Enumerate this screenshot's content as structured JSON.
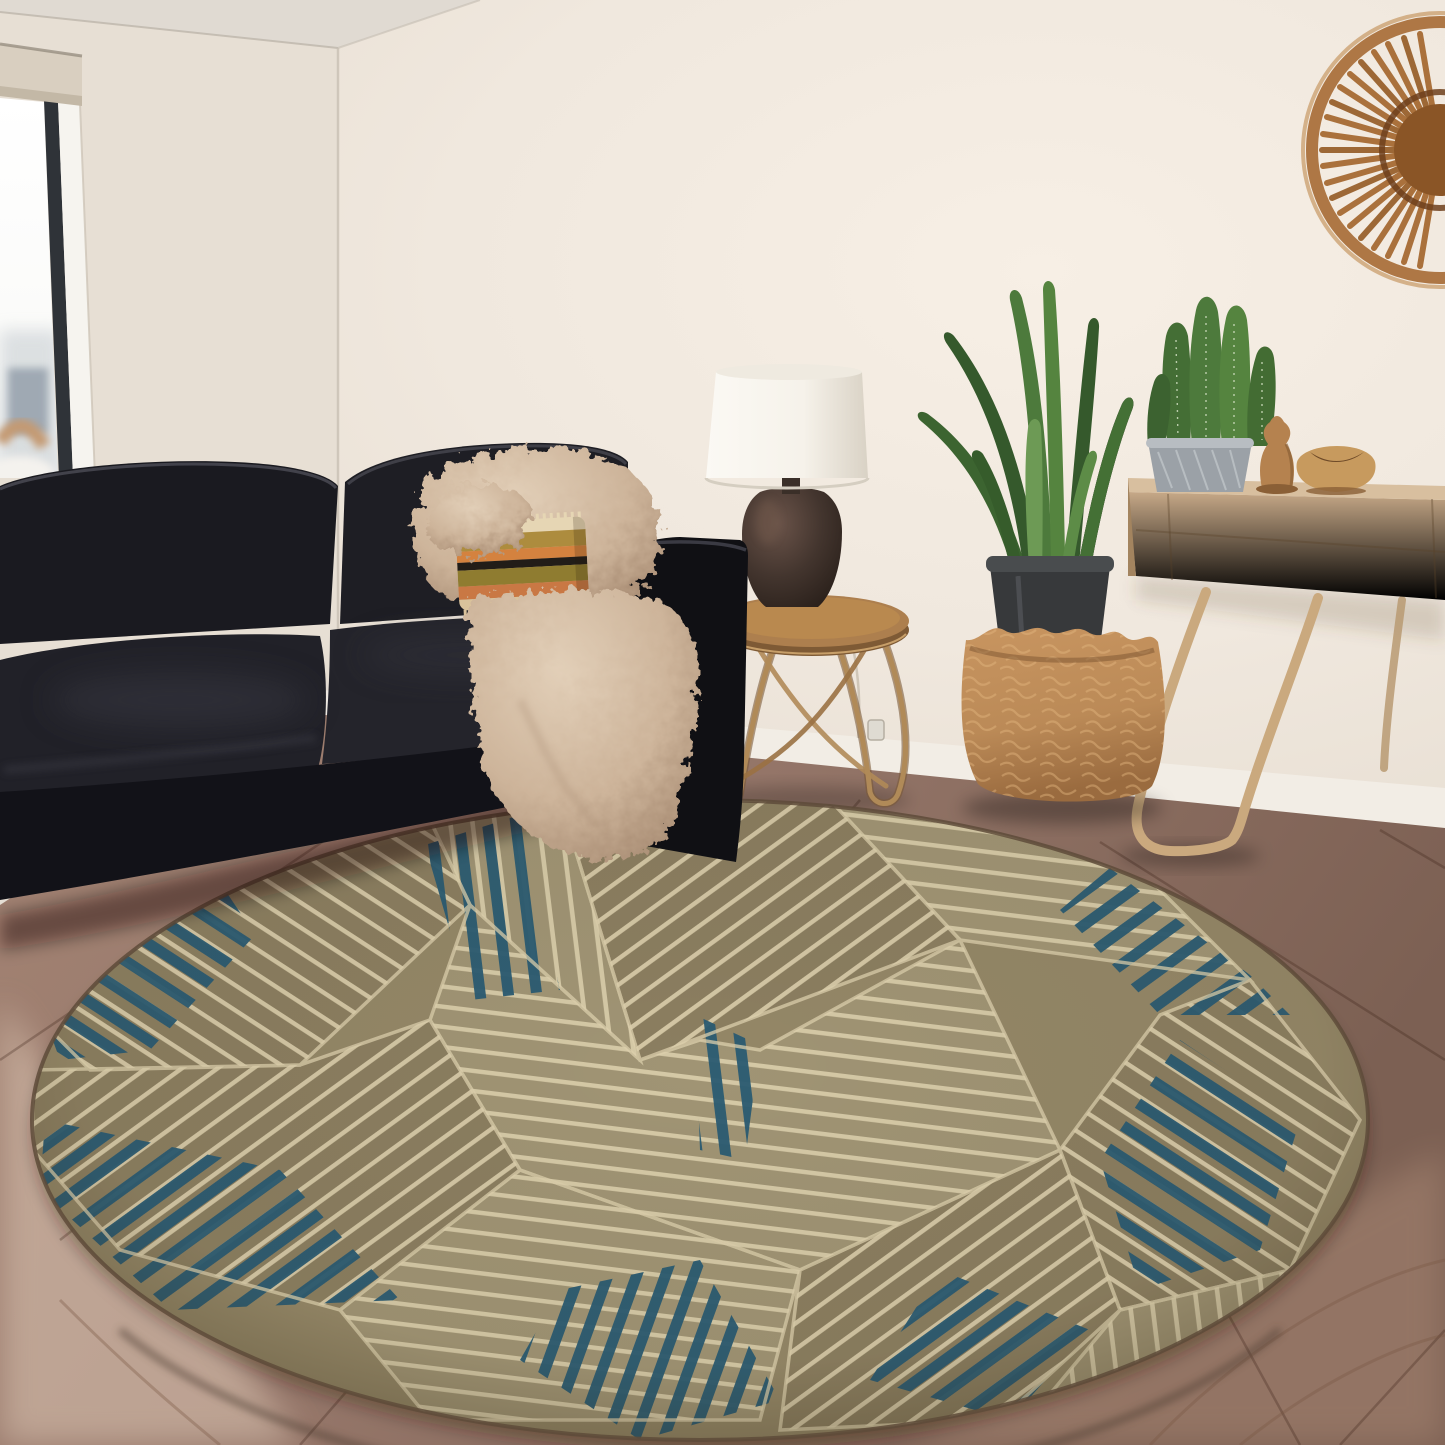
{
  "scene": {
    "alt": "Bright living room photo: black leather sofa with fur throw and striped boho pillow by a tall window, round side table with ceramic lamp, snake plant in a woven basket planter, oak console with cactus, wooden sculpture and bowl, rattan fan wall decor, and a round geometric area rug in taupe, cream and teal on warm hardwood flooring."
  },
  "objects": [
    "window-with-roller-shade",
    "black-leather-sofa",
    "fur-throw",
    "striped-boho-pillow",
    "round-side-table",
    "ceramic-table-lamp",
    "snake-plant",
    "woven-basket-planter",
    "oak-console-table",
    "potted-cactus",
    "wooden-sculpture",
    "wooden-bowl",
    "rattan-wall-fan",
    "round-geometric-area-rug",
    "hardwood-floor"
  ],
  "colors": {
    "wall": "#eee6dc",
    "wallLeft": "#e7dfd4",
    "ceiling": "#e0dad2",
    "floor": "#96776a",
    "floorDark": "#7c6053",
    "floorLight": "#dcc6b4",
    "baseboard": "#f2ede5",
    "windowFrame": "#2f3338",
    "glass": "#fafaf8",
    "shadeBeige": "#d9cfc0",
    "sofaBlack": "#1a1a20",
    "sofaDeep": "#101014",
    "sofaSeat": "#212128",
    "fur": "#cdb49a",
    "furLight": "#e2cfb8",
    "pillowCream": "#e6d6b4",
    "pillowGold": "#ad8c3e",
    "pillowOrange": "#d4823f",
    "pillowBlack": "#221d18",
    "pillowOlive": "#8f7c30",
    "pillowRust": "#c97844",
    "tableWood": "#ad7f4e",
    "wire": "#b08a58",
    "lampShade": "#f6f2ea",
    "lampBase": "#43352e",
    "plantGreen": "#4d7a3c",
    "plantDark": "#35592c",
    "plantLight": "#6d9a55",
    "potBlack": "#37393b",
    "basket": "#bb8a57",
    "basketLine": "#e3b77f",
    "console": "#c7a988",
    "consoleTop": "#d8bf9f",
    "legWood": "#caa97e",
    "potGray": "#9ba1a7",
    "sculpture": "#b5824f",
    "bowl": "#c79a5e",
    "rattan": "#aa713c",
    "rattanDark": "#8a5526",
    "rugBase": "#948767",
    "rugTone2": "#8b7e60",
    "rugTone3": "#a09474",
    "rugCream": "#ddd0ad",
    "rugBlue": "#2a5a72",
    "rugEdge": "#5e4b39"
  }
}
